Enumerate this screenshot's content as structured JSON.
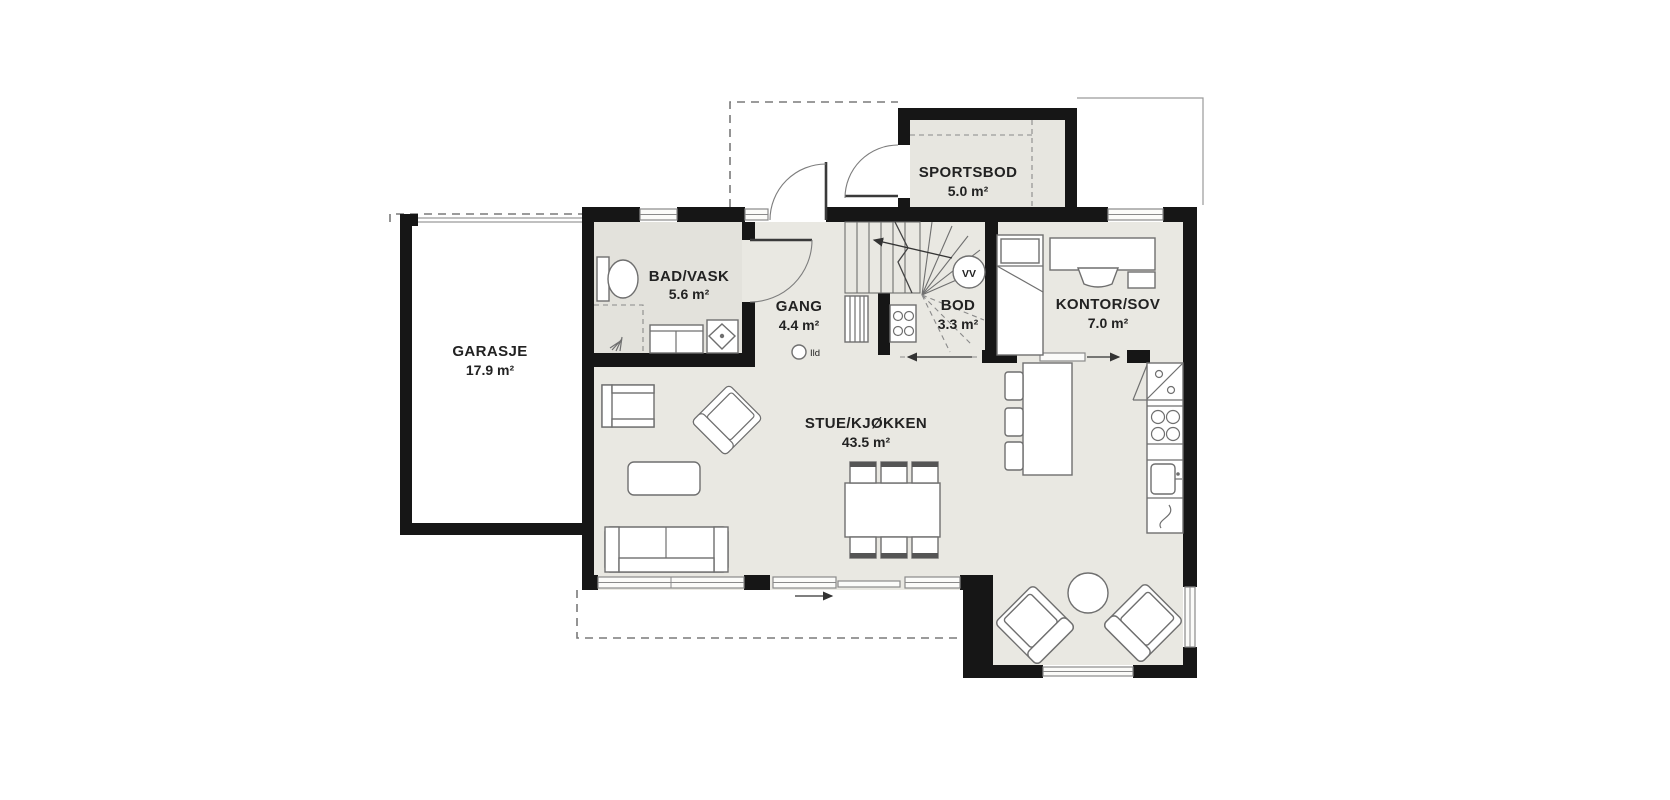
{
  "plan": {
    "title": "First floor plan",
    "rooms": [
      {
        "id": "garasje",
        "name": "GARASJE",
        "area": "17.9 m²"
      },
      {
        "id": "bad_vask",
        "name": "BAD/VASK",
        "area": "5.6 m²"
      },
      {
        "id": "gang",
        "name": "GANG",
        "area": "4.4 m²"
      },
      {
        "id": "sportsbod",
        "name": "SPORTSBOD",
        "area": "5.0 m²"
      },
      {
        "id": "bod",
        "name": "BOD",
        "area": "3.3 m²"
      },
      {
        "id": "kontor_sov",
        "name": "KONTOR/SOV",
        "area": "7.0 m²"
      },
      {
        "id": "stue_kjokken",
        "name": "STUE/KJØKKEN",
        "area": "43.5 m²"
      }
    ],
    "symbols": {
      "water_heater": "VV",
      "fireplace": "Ild"
    },
    "colors": {
      "wall": "#161616",
      "floor": "#e9e8e2",
      "background": "#ffffff",
      "furniture_stroke": "#6f6f6f"
    }
  }
}
